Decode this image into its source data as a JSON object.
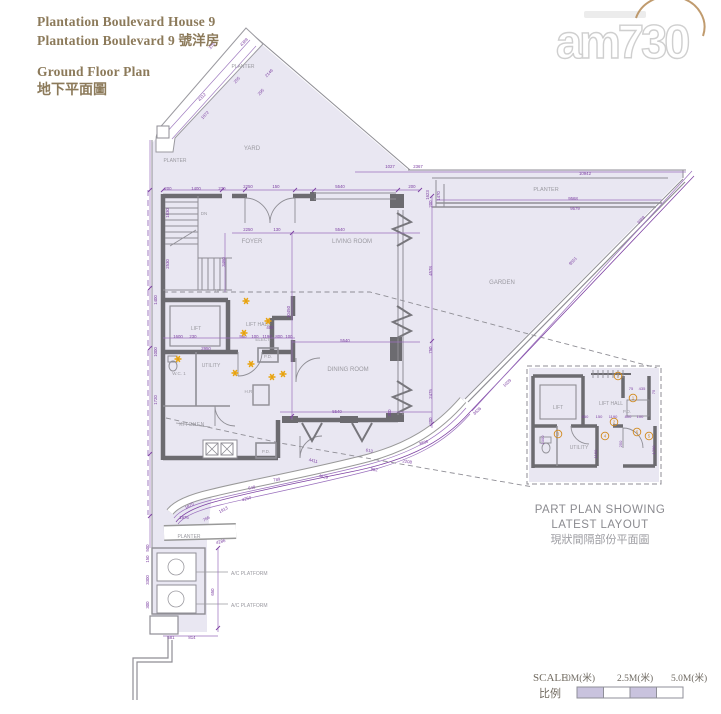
{
  "title": {
    "line1": "Plantation Boulevard House 9",
    "line2": "Plantation Boulevard 9 號洋房",
    "line3": "Ground Floor Plan",
    "line4": "地下平面圖"
  },
  "logo": {
    "text": "am730"
  },
  "plan": {
    "struck_label": "KITCHEN",
    "rooms": [
      {
        "x": 252,
        "y": 150,
        "t": "YARD",
        "s": 6
      },
      {
        "x": 252,
        "y": 243,
        "t": "FOYER",
        "s": 6
      },
      {
        "x": 352,
        "y": 243,
        "t": "LIVING ROOM",
        "s": 6
      },
      {
        "x": 502,
        "y": 284,
        "t": "GARDEN",
        "s": 6
      },
      {
        "x": 348,
        "y": 371,
        "t": "DINING ROOM",
        "s": 6
      },
      {
        "x": 196,
        "y": 330,
        "t": "LIFT",
        "s": 5
      },
      {
        "x": 258,
        "y": 326,
        "t": "LIFT HALL",
        "s": 5
      },
      {
        "x": 211,
        "y": 367,
        "t": "UTILITY",
        "s": 5
      },
      {
        "x": 179,
        "y": 375,
        "t": "W.C. 1",
        "s": 4.5
      },
      {
        "x": 263,
        "y": 341,
        "t": "ELECT.",
        "s": 4.5
      },
      {
        "x": 268,
        "y": 358,
        "t": "P.D.",
        "s": 4.5
      },
      {
        "x": 249,
        "y": 393,
        "t": "H.R.",
        "s": 4.5
      },
      {
        "x": 266,
        "y": 453,
        "t": "P.D.",
        "s": 4.5
      },
      {
        "x": 243,
        "y": 68,
        "t": "PLANTER",
        "s": 5
      },
      {
        "x": 175,
        "y": 162,
        "t": "PLANTER",
        "s": 5
      },
      {
        "x": 546,
        "y": 191,
        "t": "PLANTER",
        "s": 5.5
      },
      {
        "x": 189,
        "y": 538,
        "t": "PLANTER",
        "s": 5
      },
      {
        "x": 231,
        "y": 575,
        "t": "A/C PLATFORM",
        "s": 5,
        "a": "start"
      },
      {
        "x": 231,
        "y": 607,
        "t": "A/C PLATFORM",
        "s": 5,
        "a": "start"
      },
      {
        "x": 204,
        "y": 215,
        "t": "DN",
        "s": 4.5
      },
      {
        "x": 218,
        "y": 292,
        "t": "UP",
        "s": 4.5
      }
    ],
    "dimensions": [
      [
        168,
        190,
        "200",
        0
      ],
      [
        196,
        190,
        "1400",
        0
      ],
      [
        222,
        190,
        "230",
        0
      ],
      [
        248,
        188,
        "2250",
        0
      ],
      [
        276,
        188,
        "150",
        0
      ],
      [
        340,
        188,
        "5540",
        0
      ],
      [
        412,
        188,
        "200",
        0
      ],
      [
        248,
        231,
        "2250",
        0
      ],
      [
        277,
        231,
        "130",
        0
      ],
      [
        340,
        231,
        "5540",
        0
      ],
      [
        225,
        262,
        "3460",
        -90
      ],
      [
        290,
        312,
        "10450",
        -90
      ],
      [
        432,
        204,
        "200",
        -90
      ],
      [
        432,
        271,
        "4578",
        -90
      ],
      [
        432,
        350,
        "750",
        -90
      ],
      [
        432,
        394,
        "2475",
        -90
      ],
      [
        432,
        421,
        "200",
        -90
      ],
      [
        390,
        168,
        "1027",
        0
      ],
      [
        418,
        168,
        "2367",
        0
      ],
      [
        585,
        175,
        "10942",
        0
      ],
      [
        573,
        200,
        "9568",
        0
      ],
      [
        575,
        210,
        "9579",
        0
      ],
      [
        429,
        195,
        "1623",
        -90
      ],
      [
        440,
        196,
        "1470",
        -90
      ],
      [
        574,
        262,
        "9551",
        -46
      ],
      [
        642,
        221,
        "3888",
        -46
      ],
      [
        178,
        338,
        "1600",
        0
      ],
      [
        193,
        338,
        "230",
        0
      ],
      [
        206,
        350,
        "2950",
        0
      ],
      [
        243,
        338,
        "960",
        0
      ],
      [
        255,
        338,
        "100",
        0
      ],
      [
        267,
        338,
        "1190",
        0
      ],
      [
        279,
        338,
        "800",
        0
      ],
      [
        289,
        338,
        "100",
        0
      ],
      [
        270,
        329,
        "400",
        0
      ],
      [
        345,
        342,
        "5540",
        0
      ],
      [
        337,
        413,
        "5540",
        0
      ],
      [
        391,
        413,
        "300",
        -90
      ],
      [
        169,
        213,
        "1830",
        -90
      ],
      [
        169,
        264,
        "2530",
        -90
      ],
      [
        157,
        300,
        "1400",
        -90
      ],
      [
        157,
        352,
        "1000",
        -90
      ],
      [
        157,
        400,
        "1720",
        -90
      ],
      [
        313,
        462,
        "4411",
        12
      ],
      [
        323,
        478,
        "4629",
        12
      ],
      [
        374,
        471,
        "982",
        8
      ],
      [
        369,
        452,
        "613",
        10
      ],
      [
        407,
        463,
        "2208",
        8
      ],
      [
        424,
        444,
        "3836",
        -18
      ],
      [
        478,
        412,
        "3636",
        -42
      ],
      [
        508,
        384,
        "1039",
        -42
      ],
      [
        252,
        489,
        "648",
        -10
      ],
      [
        277,
        481,
        "789",
        -10
      ],
      [
        224,
        511,
        "1913",
        -28
      ],
      [
        207,
        520,
        "766",
        -30
      ],
      [
        221,
        543,
        "4286",
        -14
      ],
      [
        247,
        500,
        "4250",
        -16
      ],
      [
        190,
        507,
        "1870",
        -30
      ],
      [
        184,
        519,
        "1976",
        0
      ],
      [
        171,
        639,
        "581",
        0
      ],
      [
        192,
        639,
        "814",
        0
      ],
      [
        214,
        592,
        "650",
        -90
      ],
      [
        149,
        580,
        "3300",
        -90
      ],
      [
        149,
        548,
        "500",
        -90
      ],
      [
        149,
        559,
        "150",
        -90
      ],
      [
        149,
        605,
        "300",
        -90
      ],
      [
        203,
        98,
        "4312",
        -47
      ],
      [
        206,
        116,
        "1872",
        -47
      ],
      [
        213,
        47,
        "375",
        -47
      ],
      [
        245,
        43,
        "4388",
        -47
      ],
      [
        238,
        81,
        "255",
        -47
      ],
      [
        262,
        93,
        "295",
        -47
      ],
      [
        270,
        74,
        "2146",
        -47
      ]
    ],
    "stars": [
      [
        246,
        301
      ],
      [
        268,
        321
      ],
      [
        244,
        333
      ],
      [
        178,
        359
      ],
      [
        251,
        364
      ],
      [
        235,
        373
      ],
      [
        272,
        377
      ],
      [
        283,
        374
      ]
    ]
  },
  "inset": {
    "labels": [
      {
        "x": 31,
        "y": 47,
        "t": "LIFT",
        "s": 5
      },
      {
        "x": 84,
        "y": 43,
        "t": "LIFT HALL",
        "s": 5
      },
      {
        "x": 100,
        "y": 51,
        "t": "P.D.",
        "s": 4.5
      },
      {
        "x": 52,
        "y": 87,
        "t": "UTILITY",
        "s": 5
      }
    ],
    "numbers": [
      {
        "n": "7",
        "x": 91,
        "y": 14
      },
      {
        "n": "1",
        "x": 106,
        "y": 36
      },
      {
        "n": "2",
        "x": 87,
        "y": 60
      },
      {
        "n": "3",
        "x": 31,
        "y": 72
      },
      {
        "n": "4",
        "x": 78,
        "y": 74
      },
      {
        "n": "6",
        "x": 110,
        "y": 70
      },
      {
        "n": "5",
        "x": 122,
        "y": 74
      }
    ],
    "dimensions": [
      [
        58,
        56,
        "650",
        0
      ],
      [
        72,
        56,
        "150",
        0
      ],
      [
        86,
        56,
        "1190",
        0
      ],
      [
        101,
        56,
        "800",
        0
      ],
      [
        113,
        56,
        "100",
        0
      ],
      [
        104,
        28,
        "75",
        0
      ],
      [
        115,
        28,
        "435",
        0
      ],
      [
        17,
        78,
        "1000",
        -90
      ],
      [
        95,
        82,
        "250",
        -90
      ],
      [
        128,
        88,
        "1700",
        -90
      ],
      [
        70,
        92,
        "1150",
        -90
      ],
      [
        128,
        30,
        "75",
        -90
      ]
    ],
    "caption1": "PART PLAN SHOWING",
    "caption2": "LATEST LAYOUT",
    "caption3": "現狀間隔部份平面圖"
  },
  "scale_bar": {
    "label_en": "SCALE",
    "label_zh": "比例",
    "tick0": "0M(米)",
    "tick1": "2.5M(米)",
    "tick2": "5.0M(米)"
  },
  "colors": {
    "fill": "#e9e7f2",
    "wall": "#6c6b70",
    "gray_line": "#8f8e95",
    "purple": "#7e42a3",
    "label": "#9b9aa1",
    "star": "#e8a30e",
    "circle_num": "#d28a1e",
    "title": "#8c7a5a",
    "scale_fill": "#c9c3de"
  }
}
